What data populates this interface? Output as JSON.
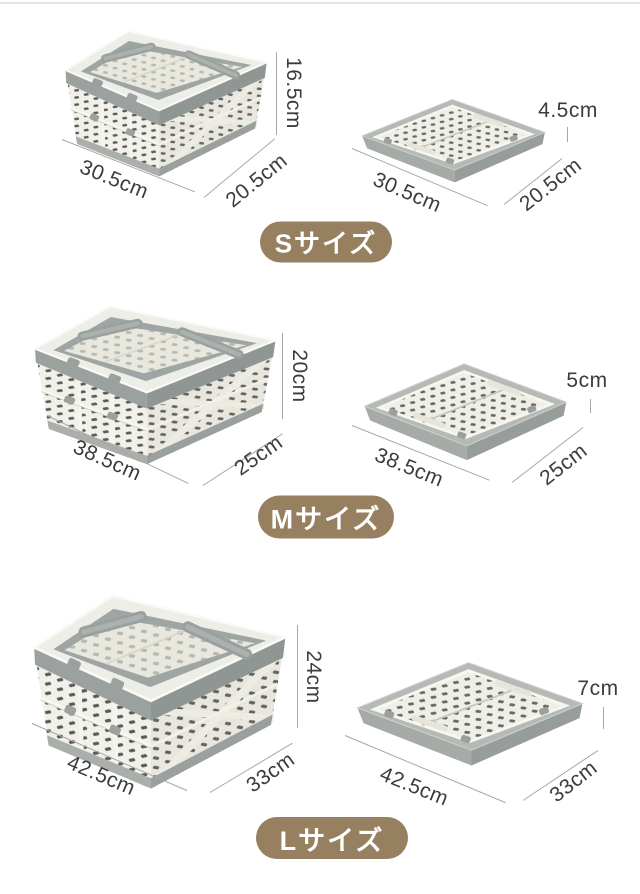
{
  "page": {
    "background": "#ffffff",
    "divider_color": "#e4e3e0"
  },
  "styles": {
    "badge_background": "#96805f",
    "badge_text_color": "#ffffff",
    "dimension_text_color": "#3c3c3c",
    "dimension_line_color": "#a7a7a7",
    "basket_body_color": "#f2f1e9",
    "basket_rim_color": "#9ba19f",
    "basket_slot_color": "#43484a"
  },
  "sections": [
    {
      "size_id": "S",
      "badge_label": "Sサイズ",
      "open": {
        "width_label": "30.5cm",
        "depth_label": "20.5cm",
        "height_label": "16.5cm"
      },
      "folded": {
        "width_label": "30.5cm",
        "depth_label": "20.5cm",
        "height_label": "4.5cm"
      }
    },
    {
      "size_id": "M",
      "badge_label": "Mサイズ",
      "open": {
        "width_label": "38.5cm",
        "depth_label": "25cm",
        "height_label": "20cm"
      },
      "folded": {
        "width_label": "38.5cm",
        "depth_label": "25cm",
        "height_label": "5cm"
      }
    },
    {
      "size_id": "L",
      "badge_label": "Lサイズ",
      "open": {
        "width_label": "42.5cm",
        "depth_label": "33cm",
        "height_label": "24cm"
      },
      "folded": {
        "width_label": "42.5cm",
        "depth_label": "33cm",
        "height_label": "7cm"
      }
    }
  ]
}
